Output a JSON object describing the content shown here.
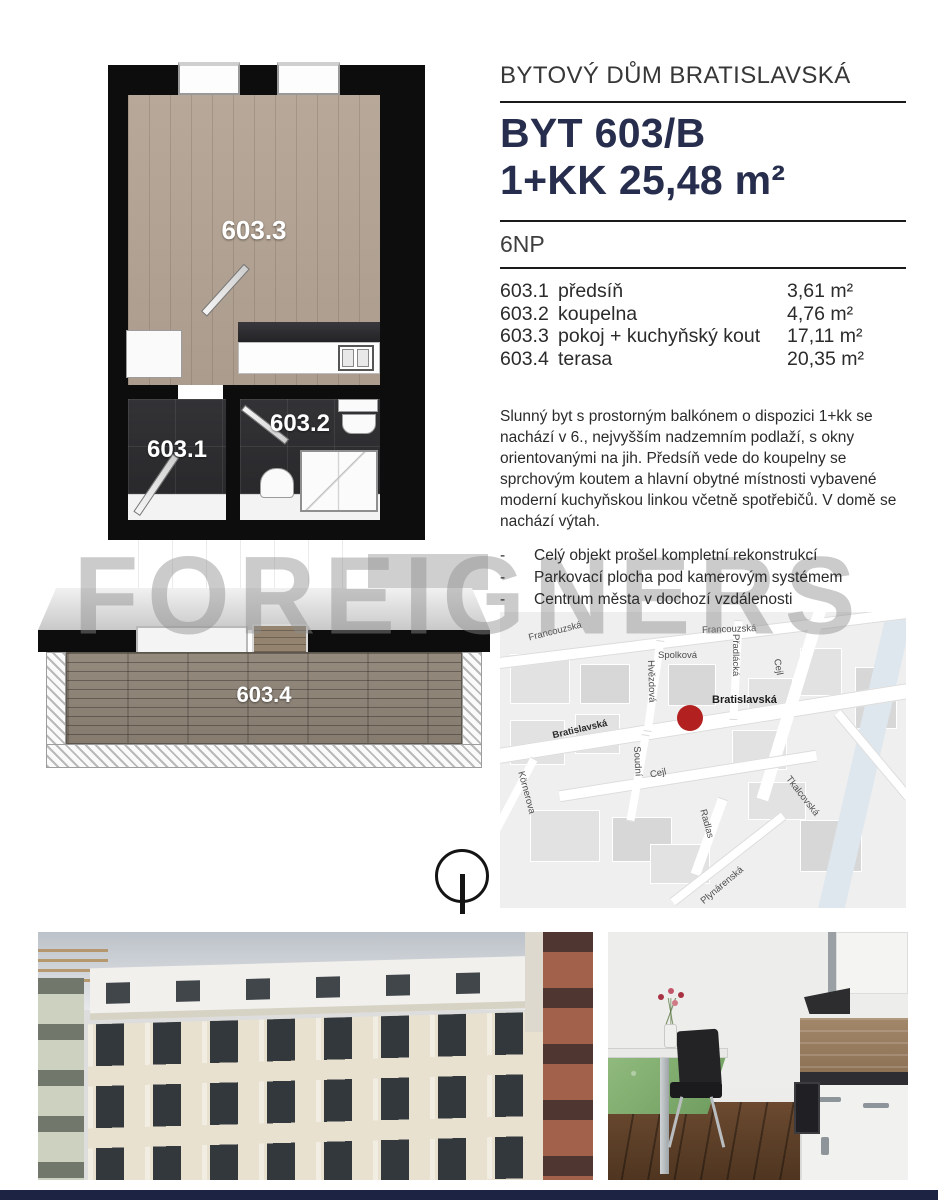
{
  "page": {
    "watermark": "FOREIGNERS"
  },
  "header": {
    "project": "BYTOVÝ DŮM BRATISLAVSKÁ",
    "unit": "BYT 603/B",
    "layout_area": "1+KK 25,48 m²",
    "floor": "6NP"
  },
  "rooms": [
    {
      "code": "603.1",
      "name": "předsíň",
      "area": "3,61 m²"
    },
    {
      "code": "603.2",
      "name": "koupelna",
      "area": "4,76 m²"
    },
    {
      "code": "603.3",
      "name": "pokoj + kuchyňský kout",
      "area": "17,11 m²"
    },
    {
      "code": "603.4",
      "name": "terasa",
      "area": "20,35 m²"
    }
  ],
  "description": "Slunný byt s prostorným balkónem o dispozici 1+kk se nachází v 6., nejvyšším nadzemním podlaží, s okny orientovanými na jih.  Předsíň vede do koupelny se sprchovým koutem a hlavní obytné místnosti vybavené moderní kuchyňskou linkou včetně spotřebičů. V domě se nachází výtah.",
  "bullet_dash": "-",
  "bullets": [
    "Celý objekt prošel kompletní rekonstrukcí",
    "Parkovací plocha pod kamerovým systémem",
    "Centrum města v dochozí vzdálenosti"
  ],
  "plan": {
    "room1_label": "603.1",
    "room2_label": "603.2",
    "room3_label": "603.3",
    "terrace_label": "603.4"
  },
  "map": {
    "marker_label": "Bratislavská",
    "streets": [
      "Francouzská",
      "Francouzská",
      "Spolková",
      "Hvězdová",
      "Přadlácká",
      "Cejl",
      "Bratislavská",
      "Soudní",
      "Körnerova",
      "Cejl",
      "Radlas",
      "Plynárenská",
      "Tkalcovská"
    ]
  },
  "colors": {
    "title_navy": "#272e4d",
    "marker_red": "#b2201f",
    "footer_navy": "#1d2342",
    "watermark_gray": "#8c8c8c"
  }
}
